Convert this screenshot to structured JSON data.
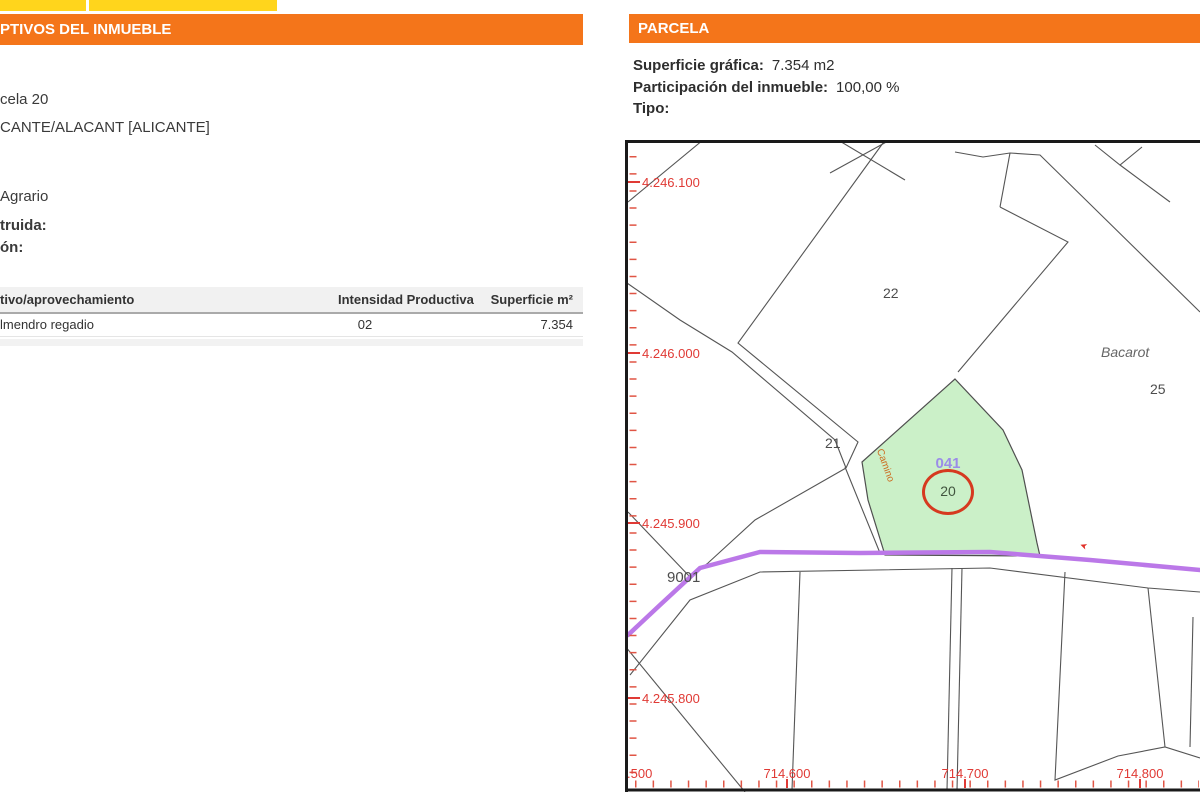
{
  "top_tabs": {
    "color": "#FFD51C"
  },
  "left_panel": {
    "header": "PTIVOS DEL INMUEBLE",
    "info_lines": [
      "cela 20",
      "CANTE/ALACANT [ALICANTE]",
      "Agrario"
    ],
    "bold_labels": [
      "truida:",
      "ón:"
    ],
    "table": {
      "headers": [
        "tivo/aprovechamiento",
        "Intensidad Productiva",
        "Superficie m²"
      ],
      "rows": [
        {
          "cultivo": "lmendro regadio",
          "intensidad": "02",
          "superficie": "7.354"
        }
      ]
    }
  },
  "right_panel": {
    "header": "PARCELA",
    "fields": [
      {
        "label": "Superficie gráfica:",
        "value": "7.354 m2"
      },
      {
        "label": "Participación del inmueble:",
        "value": "100,00 %"
      },
      {
        "label": "Tipo:",
        "value": ""
      }
    ],
    "map": {
      "y_axis_labels": [
        "4.246.100",
        "4.246.000",
        "4.245.900",
        "4.245.800"
      ],
      "x_axis_labels": [
        ".500",
        "714.600",
        "714.700",
        "714.800"
      ],
      "labels": {
        "parcel_22": "22",
        "parcel_21": "21",
        "parcel_25": "25",
        "parcel_20": "20",
        "parcel_9001": "9001",
        "polygon_ref": "041",
        "place_name": "Bacarot",
        "road_name": "Camino"
      },
      "colors": {
        "selected_parcel_fill": "#cbf0c8",
        "road_purple": "#bb78e8",
        "highlight_circle_red": "#d6391f",
        "axis_red": "#e03a35",
        "ref_purple": "#9b8ce8",
        "camino_text_orange": "#cc6a1e",
        "boundary_gray": "#555555"
      }
    }
  },
  "theme": {
    "header_orange": "#F4751A",
    "tab_yellow": "#FFD51C"
  }
}
